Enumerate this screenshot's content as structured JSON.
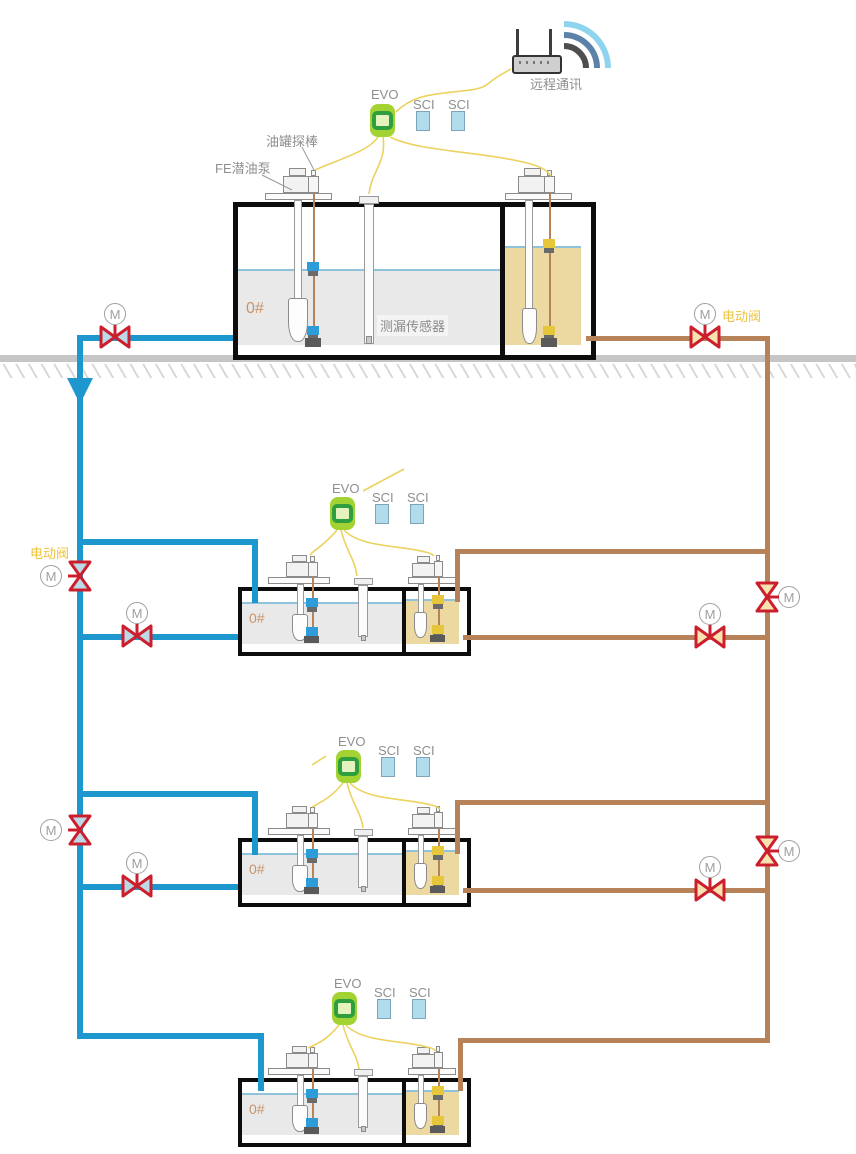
{
  "labels": {
    "remote_comm": "远程通讯",
    "tank_probe": "油罐探棒",
    "fe_pump": "FE潜油泵",
    "leak_sensor": "测漏传感器",
    "evo": "EVO",
    "sci": "SCI",
    "fuel_grade": "0#",
    "electric_valve": "电动阀",
    "valve_motor": "M"
  },
  "colors": {
    "pipe_diesel_blue": "#1e97cf",
    "pipe_gasoline_brown": "#b5825a",
    "valve_red": "#cc1f2d",
    "valve_fill_blue": "#bcd9e8",
    "valve_fill_cream": "#f7e3af",
    "evo_green": "#a3d332",
    "sci_blue": "#b0dcec",
    "wire_yellow": "#ecd25e",
    "diesel_liquid_gray": "#e9e9e9",
    "gasoline_liquid_tan": "#ecd9a2",
    "wifi_arc_outer": "#8fd4ef",
    "wifi_arc_mid": "#5d82a8",
    "wifi_arc_inner": "#4e4e4e"
  }
}
